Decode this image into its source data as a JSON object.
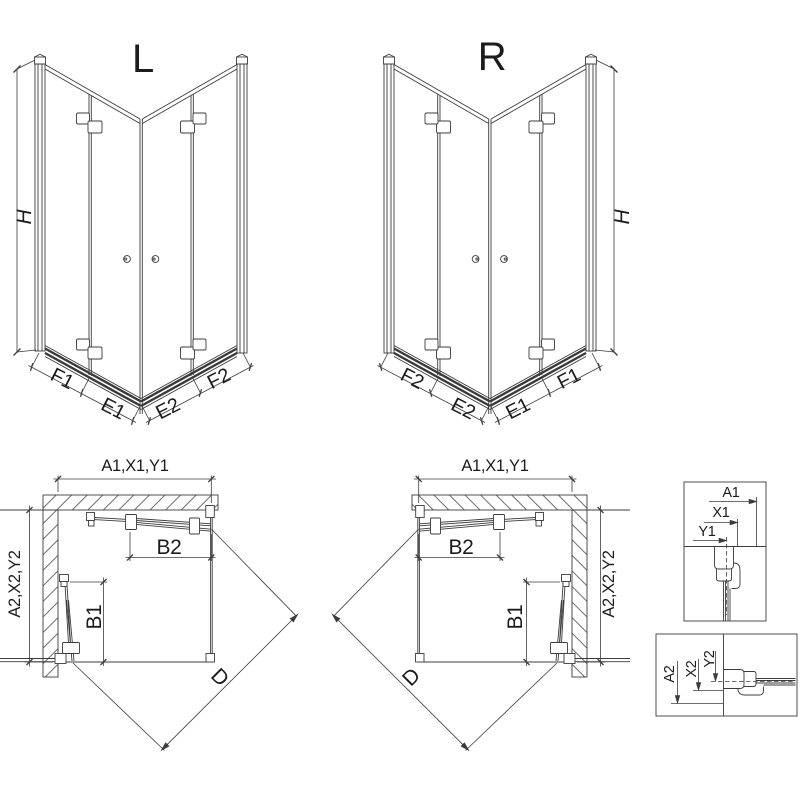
{
  "page": {
    "background": "#ffffff",
    "line_color": "#3c3c3c",
    "text_color": "#1c1c1c"
  },
  "views": {
    "iso_left": {
      "title": "L",
      "height_dim": "H",
      "bottom_dims": [
        "F1",
        "E1",
        "E2",
        "F2"
      ]
    },
    "iso_right": {
      "title": "R",
      "height_dim": "H",
      "bottom_dims": [
        "F2",
        "E2",
        "E1",
        "F1"
      ]
    },
    "plan_left": {
      "width_dim": "A1,X1,Y1",
      "depth_dim": "A2,X2,Y2",
      "top_door_dim": "B2",
      "side_door_dim": "B1",
      "diagonal_dim": "D"
    },
    "plan_right": {
      "width_dim": "A1,X1,Y1",
      "depth_dim": "A2,X2,Y2",
      "top_door_dim": "B2",
      "side_door_dim": "B1",
      "diagonal_dim": "D"
    },
    "detail_profile_top": {
      "dims": [
        "A1",
        "X1",
        "Y1"
      ]
    },
    "detail_profile_side": {
      "dims": [
        "A2",
        "X2",
        "Y2"
      ]
    }
  }
}
